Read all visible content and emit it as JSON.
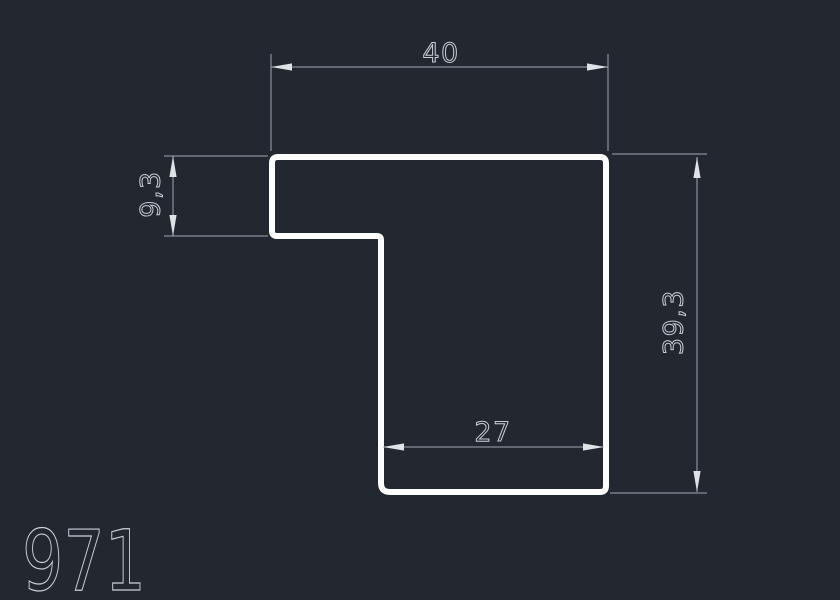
{
  "drawing": {
    "part_number": "971",
    "dimensions": {
      "top_width": "40",
      "left_height": "9,3",
      "right_height": "39,3",
      "bottom_width": "27"
    },
    "colors": {
      "background": "#232730",
      "profile_stroke": "#fdfdfe",
      "dimension_lines": "#a0a6af",
      "dimension_text": "#c9ced6",
      "arrowheads": "#dfe2e7"
    }
  }
}
